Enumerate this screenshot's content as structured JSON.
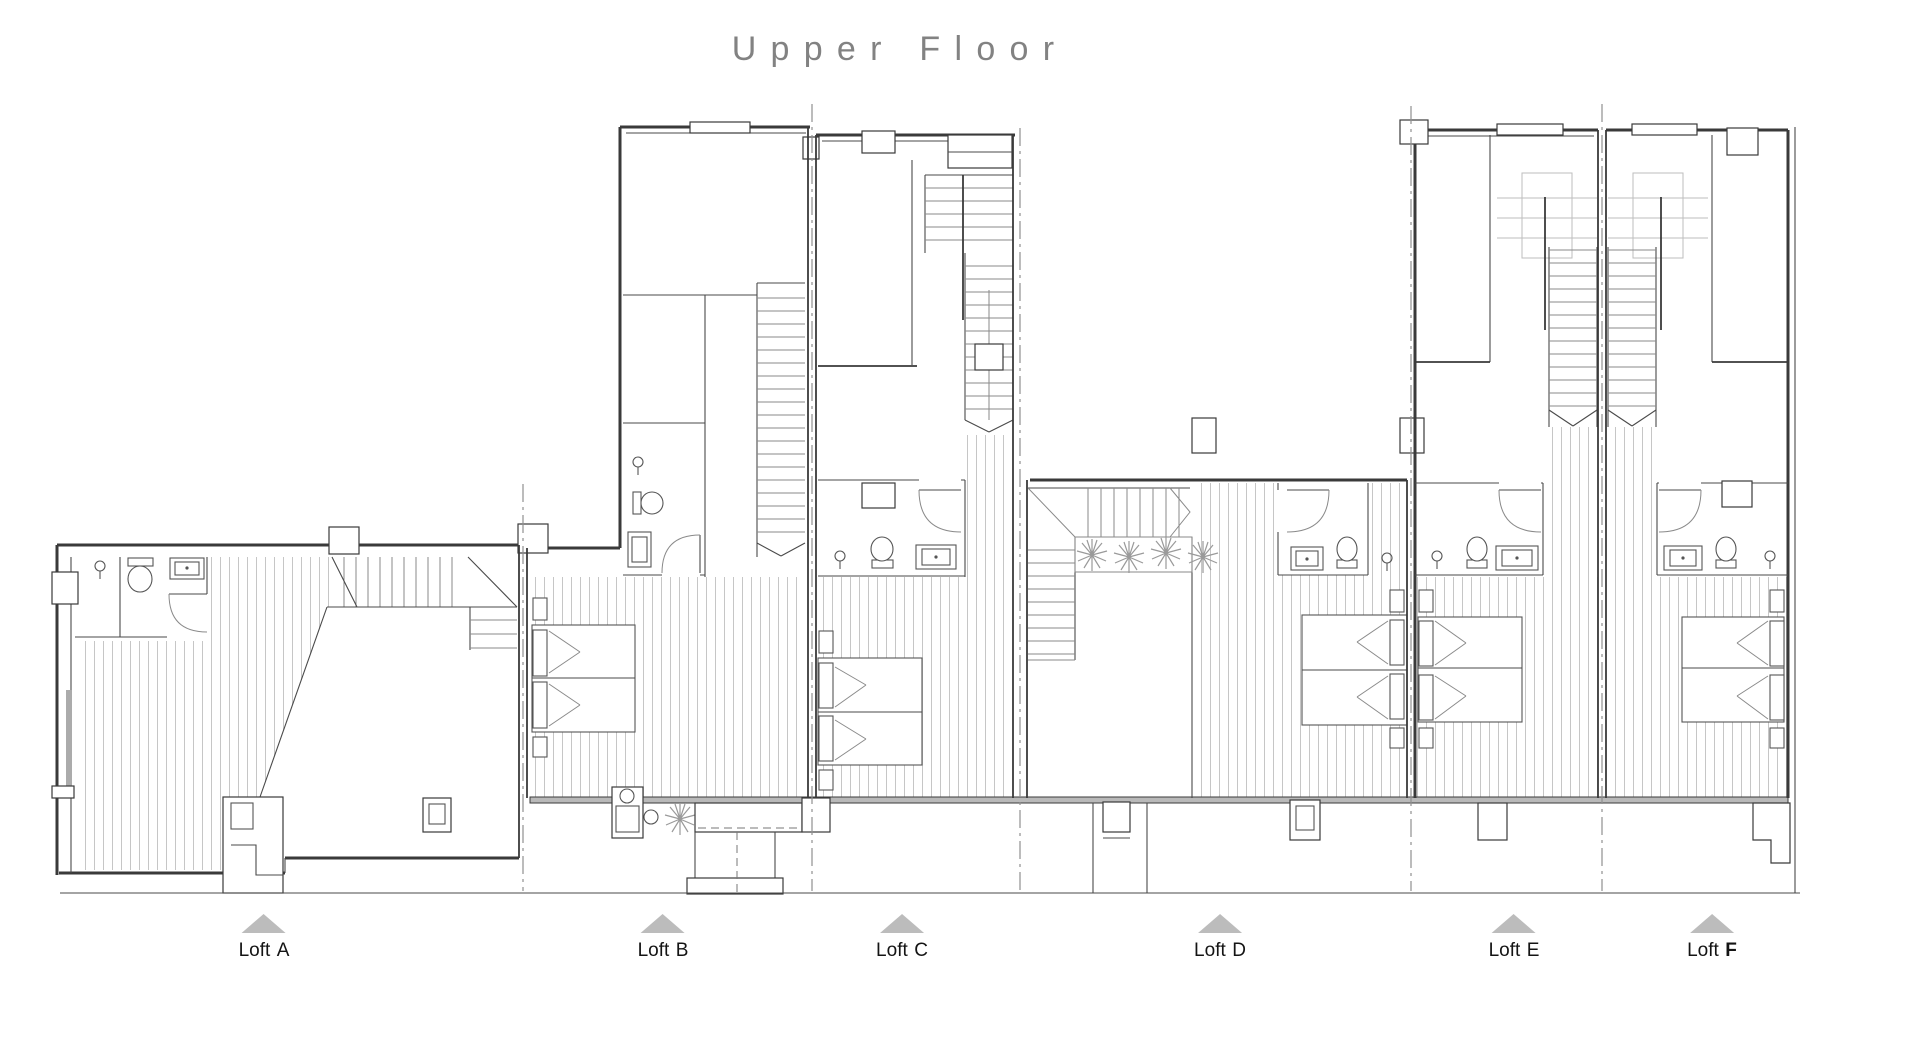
{
  "title": "Upper Floor",
  "lofts": [
    {
      "prefix": "Loft",
      "letter": "A"
    },
    {
      "prefix": "Loft",
      "letter": "B"
    },
    {
      "prefix": "Loft",
      "letter": "C"
    },
    {
      "prefix": "Loft",
      "letter": "D"
    },
    {
      "prefix": "Loft",
      "letter": "E"
    },
    {
      "prefix": "Loft",
      "letter": "F"
    }
  ],
  "drawing": {
    "type": "architectural-floor-plan",
    "floor_shown": "Upper Floor",
    "unit_count": 6,
    "symbols": [
      "staircase",
      "double-bed",
      "toilet",
      "washbasin",
      "door-swing",
      "ceiling-light",
      "plant",
      "chimney",
      "wood-floor-hatch",
      "party-wall-dashed-line",
      "entrance-triangle-marker"
    ]
  },
  "palette": {
    "background": "#ffffff",
    "wall": "#3a3a3a",
    "hatch_line": "#c6c6c6",
    "stair_line": "#8a8a8a",
    "faint_line": "#bdbdbd",
    "dash_line": "#909090",
    "triangle": "#bcbcbc",
    "title_text": "#828282",
    "label_text": "#141414"
  }
}
